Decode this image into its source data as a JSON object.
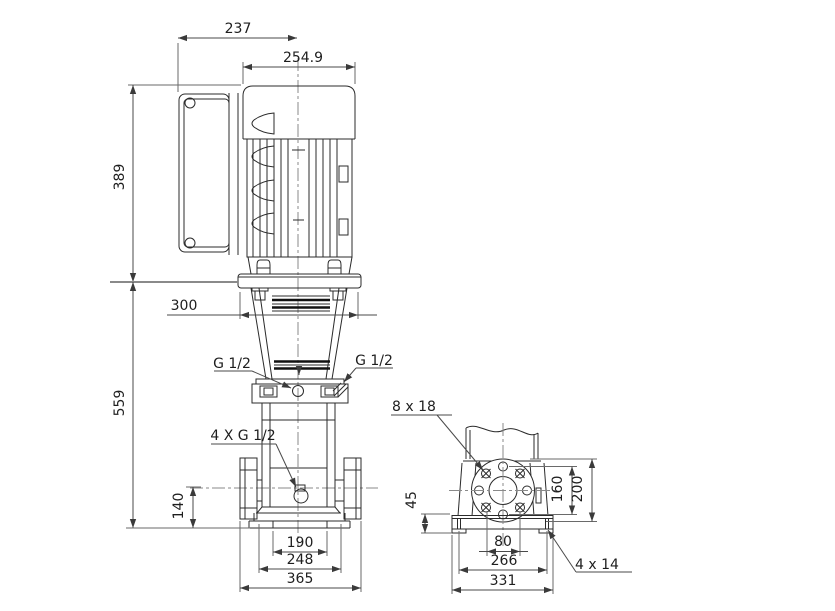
{
  "side": {
    "d237": "237",
    "d2549": "254.9",
    "d389": "389",
    "d300": "300",
    "d559": "559",
    "d140": "140",
    "g12_left": "G 1/2",
    "g12_right": "G 1/2",
    "g12_four": "4 X G 1/2",
    "d190": "190",
    "d248": "248",
    "d365": "365"
  },
  "front": {
    "holes8x18": "8 x 18",
    "d45": "45",
    "d160": "160",
    "d200": "200",
    "d80": "80",
    "d266": "266",
    "d331": "331",
    "holes4x14": "4 x 14"
  },
  "colors": {
    "background": "#ffffff",
    "line": "#2b2b2b",
    "dimension": "#4a4a4a",
    "text": "#1e1e1e"
  }
}
